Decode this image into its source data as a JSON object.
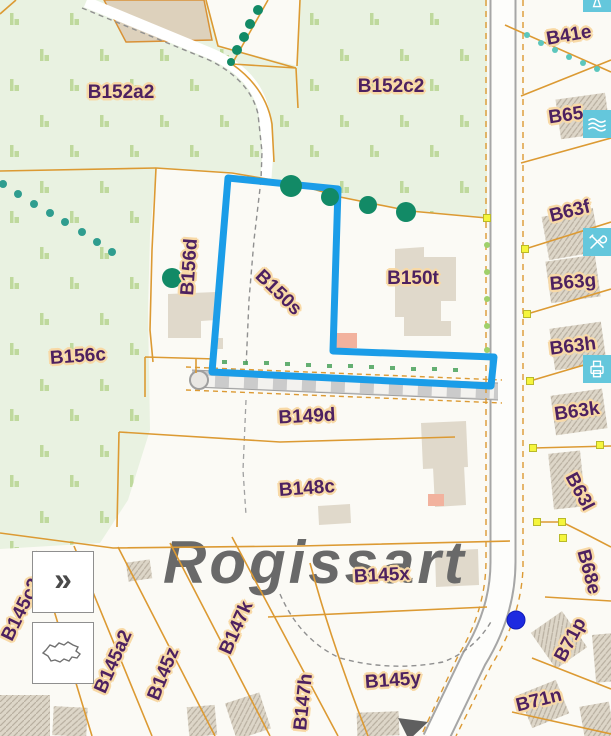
{
  "map": {
    "place_name": "Rogissart",
    "selected_parcel_label": "B150s",
    "selection_outline_points": "228,178 338,189 333,351 494,357 491,386 212,372",
    "location_dot": {
      "x": 516,
      "y": 620
    },
    "colors": {
      "selection": "#1b9de8",
      "parcel_line": "#dc9a33",
      "label_text": "#4d2160",
      "label_halo": "#f8d9a6",
      "green_area": "#e9f2e1",
      "road_edge": "#a6a6a6",
      "toolbar": "#64c7dc",
      "location_dot": "#1d2ae0",
      "vertex_marker": "#f5f53c",
      "place_text": "#696969"
    },
    "parcel_labels": [
      {
        "text": "B152a2",
        "x": 121,
        "y": 93,
        "rot": 0
      },
      {
        "text": "B152c2",
        "x": 391,
        "y": 87,
        "rot": 0
      },
      {
        "text": "B41e",
        "x": 569,
        "y": 36,
        "rot": -10
      },
      {
        "text": "B65",
        "x": 566,
        "y": 116,
        "rot": -8
      },
      {
        "text": "B63f",
        "x": 570,
        "y": 212,
        "rot": -14
      },
      {
        "text": "B63g",
        "x": 573,
        "y": 283,
        "rot": -5
      },
      {
        "text": "B63h",
        "x": 573,
        "y": 347,
        "rot": -7
      },
      {
        "text": "B63k",
        "x": 577,
        "y": 412,
        "rot": -8
      },
      {
        "text": "B63l",
        "x": 579,
        "y": 492,
        "rot": 62
      },
      {
        "text": "B68e",
        "x": 588,
        "y": 572,
        "rot": 75
      },
      {
        "text": "B71p",
        "x": 571,
        "y": 640,
        "rot": -62
      },
      {
        "text": "B71n",
        "x": 539,
        "y": 701,
        "rot": -14
      },
      {
        "text": "B156d",
        "x": 190,
        "y": 267,
        "rot": -86
      },
      {
        "text": "B150s",
        "x": 278,
        "y": 293,
        "rot": 44
      },
      {
        "text": "B150t",
        "x": 413,
        "y": 279,
        "rot": 0
      },
      {
        "text": "B156c",
        "x": 78,
        "y": 357,
        "rot": -4
      },
      {
        "text": "B149d",
        "x": 307,
        "y": 417,
        "rot": -3
      },
      {
        "text": "B148c",
        "x": 307,
        "y": 489,
        "rot": -4
      },
      {
        "text": "B145x",
        "x": 382,
        "y": 576,
        "rot": -3
      },
      {
        "text": "B145y",
        "x": 393,
        "y": 681,
        "rot": -4
      },
      {
        "text": "B145c2",
        "x": 22,
        "y": 610,
        "rot": -64
      },
      {
        "text": "B145a2",
        "x": 114,
        "y": 662,
        "rot": -66
      },
      {
        "text": "B145z",
        "x": 164,
        "y": 674,
        "rot": -68
      },
      {
        "text": "B147k",
        "x": 237,
        "y": 628,
        "rot": -66
      },
      {
        "text": "B147h",
        "x": 304,
        "y": 702,
        "rot": -84
      }
    ],
    "trees": [
      {
        "x": 258,
        "y": 10,
        "r": 5,
        "c": "#128a66"
      },
      {
        "x": 250,
        "y": 24,
        "r": 5,
        "c": "#128a66"
      },
      {
        "x": 244,
        "y": 37,
        "r": 5,
        "c": "#128a66"
      },
      {
        "x": 237,
        "y": 50,
        "r": 5,
        "c": "#128a66"
      },
      {
        "x": 231,
        "y": 62,
        "r": 4,
        "c": "#128a66"
      },
      {
        "x": 3,
        "y": 184,
        "r": 4,
        "c": "#2f9d8f"
      },
      {
        "x": 18,
        "y": 194,
        "r": 4,
        "c": "#2f9d8f"
      },
      {
        "x": 34,
        "y": 204,
        "r": 4,
        "c": "#2f9d8f"
      },
      {
        "x": 50,
        "y": 213,
        "r": 4,
        "c": "#2f9d8f"
      },
      {
        "x": 65,
        "y": 222,
        "r": 4,
        "c": "#2f9d8f"
      },
      {
        "x": 82,
        "y": 232,
        "r": 4,
        "c": "#2f9d8f"
      },
      {
        "x": 97,
        "y": 242,
        "r": 4,
        "c": "#2f9d8f"
      },
      {
        "x": 112,
        "y": 252,
        "r": 4,
        "c": "#2f9d8f"
      },
      {
        "x": 172,
        "y": 278,
        "r": 10,
        "c": "#128a66"
      },
      {
        "x": 291,
        "y": 186,
        "r": 11,
        "c": "#128a66"
      },
      {
        "x": 330,
        "y": 197,
        "r": 9,
        "c": "#128a66"
      },
      {
        "x": 368,
        "y": 205,
        "r": 9,
        "c": "#128a66"
      },
      {
        "x": 406,
        "y": 212,
        "r": 10,
        "c": "#128a66"
      },
      {
        "x": 527,
        "y": 35,
        "r": 3,
        "c": "#5cc6bd"
      },
      {
        "x": 541,
        "y": 43,
        "r": 3,
        "c": "#5cc6bd"
      },
      {
        "x": 555,
        "y": 50,
        "r": 3,
        "c": "#5cc6bd"
      },
      {
        "x": 569,
        "y": 57,
        "r": 3,
        "c": "#5cc6bd"
      },
      {
        "x": 583,
        "y": 63,
        "r": 3,
        "c": "#5cc6bd"
      },
      {
        "x": 597,
        "y": 69,
        "r": 3,
        "c": "#5cc6bd"
      },
      {
        "x": 487,
        "y": 245,
        "r": 3,
        "c": "#9fd06a"
      },
      {
        "x": 487,
        "y": 272,
        "r": 3,
        "c": "#9fd06a"
      },
      {
        "x": 487,
        "y": 299,
        "r": 3,
        "c": "#9fd06a"
      },
      {
        "x": 487,
        "y": 326,
        "r": 3,
        "c": "#9fd06a"
      },
      {
        "x": 487,
        "y": 350,
        "r": 3,
        "c": "#9fd06a"
      }
    ],
    "vertex_markers": [
      [
        487,
        218
      ],
      [
        525,
        249
      ],
      [
        527,
        314
      ],
      [
        530,
        381
      ],
      [
        533,
        448
      ],
      [
        600,
        445
      ],
      [
        537,
        522
      ],
      [
        562,
        522
      ],
      [
        563,
        538
      ]
    ]
  },
  "toolbar": {
    "buttons": [
      {
        "name": "route-icon",
        "top": -16
      },
      {
        "name": "layers-icon",
        "top": 110
      },
      {
        "name": "measure-tools-icon",
        "top": 228
      },
      {
        "name": "print-icon",
        "top": 355
      }
    ]
  },
  "controls": {
    "expand_label": "»",
    "overview_button_icon": "belgium-outline-icon"
  }
}
